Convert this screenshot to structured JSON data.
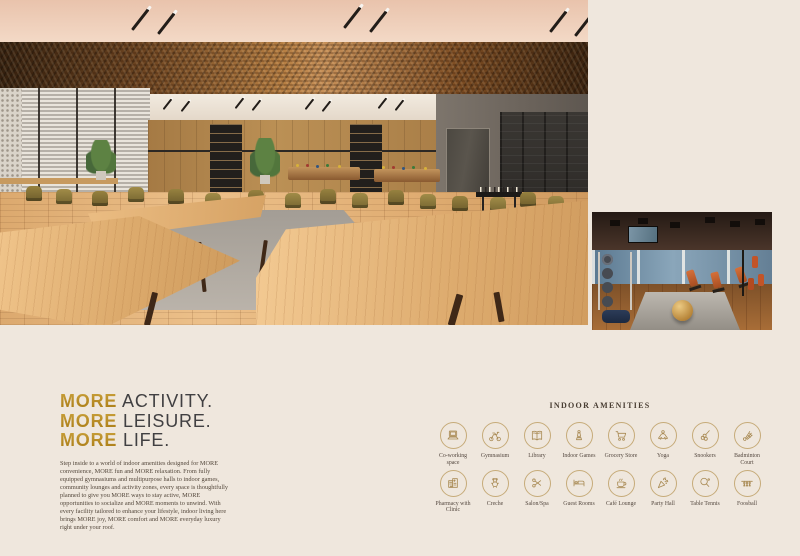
{
  "intro": {
    "heading_lines": [
      {
        "highlight": "MORE",
        "rest": "ACTIVITY."
      },
      {
        "highlight": "MORE",
        "rest": "LEISURE."
      },
      {
        "highlight": "MORE",
        "rest": "LIFE."
      }
    ],
    "body": "Step inside to a world of indoor amenities designed for MORE convenience, MORE fun and MORE relaxation. From fully equipped gymnasiums and multipurpose halls to indoor games, community lounges and activity zones, every space is thoughtfully planned to give you MORE ways to stay active, MORE opportunities to socialize and MORE moments to unwind. With every facility tailored to enhance your lifestyle, indoor living here brings MORE joy, MORE comfort and MORE everyday luxury right under your roof."
  },
  "amenities": {
    "title": "INDOOR AMENITIES",
    "rows": [
      [
        {
          "label": "Co-working space",
          "icon": "laptop-icon"
        },
        {
          "label": "Gymnasium",
          "icon": "exercise-bike-icon"
        },
        {
          "label": "Library",
          "icon": "open-book-icon"
        },
        {
          "label": "Indoor Games",
          "icon": "chess-icon"
        },
        {
          "label": "Grocery Store",
          "icon": "shopping-cart-icon"
        },
        {
          "label": "Yoga",
          "icon": "meditation-icon"
        },
        {
          "label": "Snookers",
          "icon": "billiards-icon"
        },
        {
          "label": "Badminton Court",
          "icon": "shuttlecock-icon"
        }
      ],
      [
        {
          "label": "Pharmacy with Clinic",
          "icon": "clinic-building-icon"
        },
        {
          "label": "Creche",
          "icon": "teddy-bear-icon"
        },
        {
          "label": "Salon/Spa",
          "icon": "scissors-icon"
        },
        {
          "label": "Guest Rooms",
          "icon": "bed-icon"
        },
        {
          "label": "Café Lounge",
          "icon": "coffee-cup-icon"
        },
        {
          "label": "Party Hall",
          "icon": "party-popper-icon"
        },
        {
          "label": "Table Tennis",
          "icon": "table-tennis-icon"
        },
        {
          "label": "Foosball",
          "icon": "foosball-icon"
        }
      ]
    ]
  },
  "colors": {
    "background": "#EFE7DD",
    "gold_accent": "#B9860F",
    "heading_text": "#414042",
    "body_text": "#54483C",
    "icon_stroke": "#A88952",
    "icon_circle_border": "#C6AB79"
  }
}
